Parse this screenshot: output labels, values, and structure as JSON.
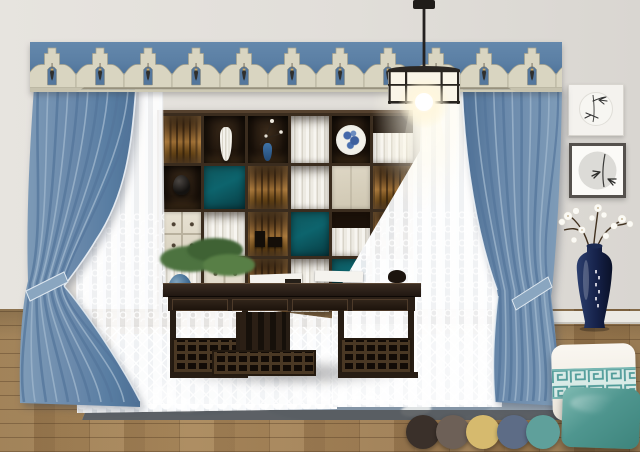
{
  "board": {
    "palette": [
      {
        "name": "espresso-brown",
        "hex": "#3a302a"
      },
      {
        "name": "warm-taupe",
        "hex": "#6d6057"
      },
      {
        "name": "antique-gold",
        "hex": "#d6ba6e"
      },
      {
        "name": "slate-blue",
        "hex": "#5d6c86"
      },
      {
        "name": "jade-teal",
        "hex": "#5fa09b"
      }
    ],
    "materials": {
      "valance_blue": "#5b7fa4",
      "valance_trim": "#d9d5c1",
      "curtain_blue": "#6a89ab",
      "sheer_white": "#f7f7f5",
      "wall": "#e1ded9",
      "floor_wood": "#9a7a52",
      "rug_blue_gray": "#a3b0bd",
      "furniture_ebony": "#271d14",
      "cabinet_teal": "#0f565c",
      "porcelain_navy": "#16224a",
      "pillow_teal": "#4f968f"
    }
  }
}
